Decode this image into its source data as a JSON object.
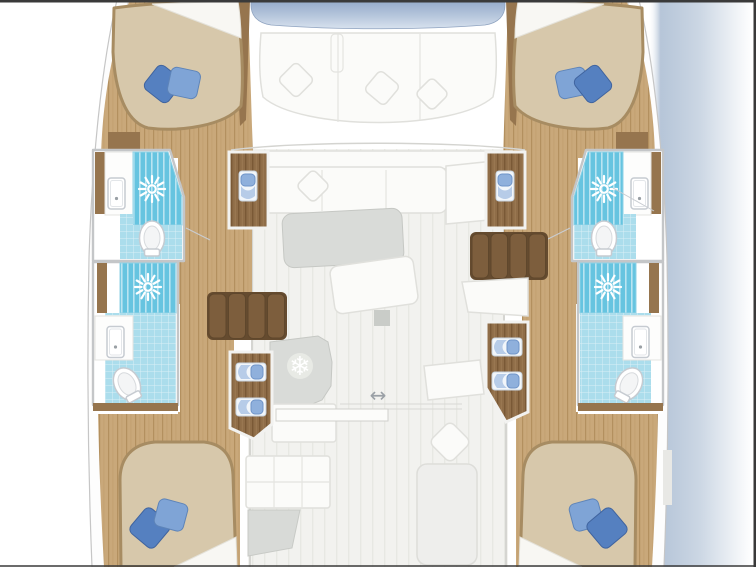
{
  "icons": [
    {
      "name": "refrigerator-icon",
      "glyph": "❄",
      "count": 1
    },
    {
      "name": "sliding-door-arrow-icon",
      "glyph": "↔",
      "count": 1
    },
    {
      "name": "shower-head-icon",
      "glyph": "sunburst",
      "count": 4
    }
  ],
  "inventory": {
    "double_berths": 4,
    "bathrooms": 4,
    "showers": 4,
    "toilets": 4,
    "sinks": 4,
    "staircases": 2,
    "wardrobes_and_lockers": 4,
    "blue_pillows": 8,
    "white_pillows": 5,
    "refrigerators": 1,
    "saloon_tables": 2,
    "forward_lounge_sofas": 1,
    "aft_loungers": 1
  },
  "colors": {
    "background": "#ffffff",
    "border_dark": "#3a3a3a",
    "hull_outline": "#c6c6c6",
    "wood_floor": "#c9a87a",
    "wood_floor_line": "#b3905f",
    "wood_trim": "#96754e",
    "wood_steps": "#7d5e3d",
    "wood_wardrobe": "#8f6d48",
    "wood_wardrobe_line": "#7a5936",
    "mattress": "#d7c8ab",
    "mattress_rim": "#a78c62",
    "sheet_white": "#f8f7f3",
    "pillow_blue_dark": "#5580c0",
    "pillow_blue_light": "#7fa4d6",
    "shower_blue": "#66c4e0",
    "tile_blue": "#abddec",
    "deck_floor": "#f2f2ef",
    "deck_stripe": "#e7e8e3",
    "table_gray": "#d9dbd8",
    "counter_gray": "#dcdeda",
    "window_top": "#93a9c9",
    "window_bottom": "#d8e2ee",
    "water_shadow": "#aebfd4",
    "towel_blue": "#8fb0dc",
    "fixture_outline": "#c6cbd1",
    "icon_gray": "#9aa0a6"
  }
}
